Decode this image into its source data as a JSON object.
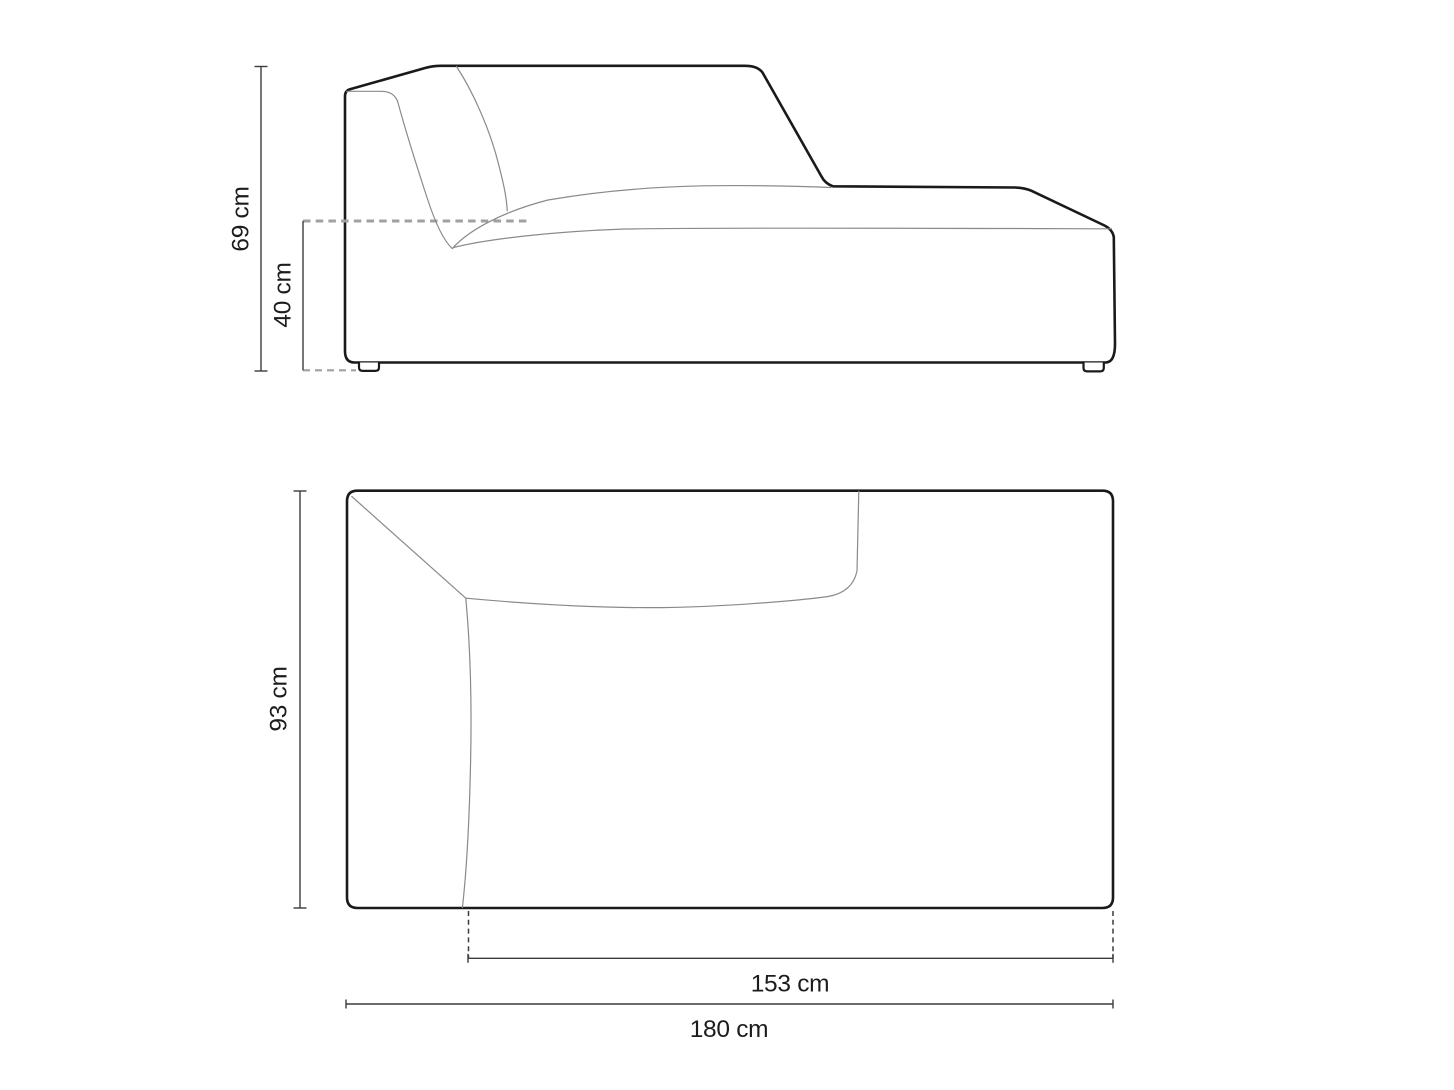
{
  "diagram": {
    "background": "#ffffff",
    "colors": {
      "outline": "#1a1a1a",
      "seam": "#8a8a8a",
      "dimension": "#3c3c3c",
      "guide": "#a0a0a0",
      "text": "#1c1c1c"
    },
    "side_view": {
      "dimensions": {
        "total_height": {
          "label": "69 cm",
          "value_cm": 69
        },
        "seat_height": {
          "label": "40 cm",
          "value_cm": 40
        }
      }
    },
    "top_view": {
      "dimensions": {
        "depth": {
          "label": "93 cm",
          "value_cm": 93
        },
        "seat_width": {
          "label": "153 cm",
          "value_cm": 153
        },
        "total_width": {
          "label": "180 cm",
          "value_cm": 180
        }
      }
    }
  }
}
